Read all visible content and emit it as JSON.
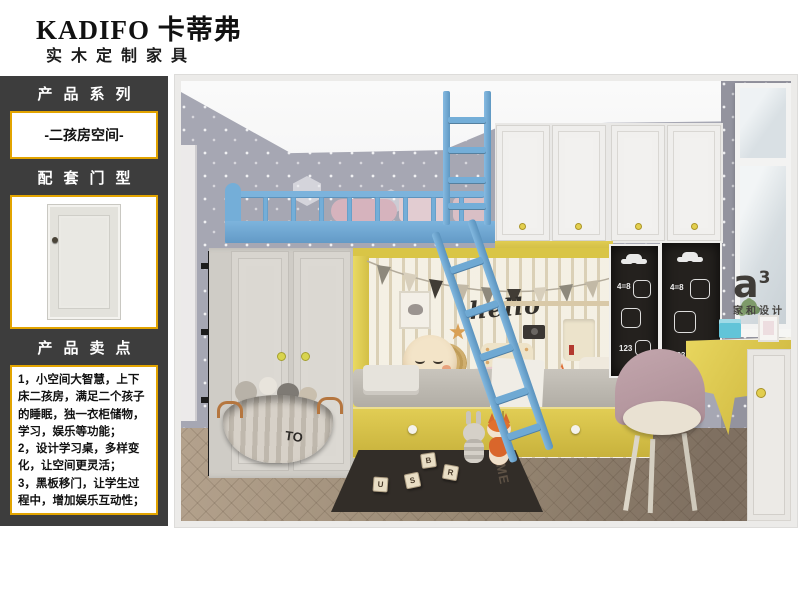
{
  "header": {
    "brand": "KADIFO 卡蒂弗",
    "tagline": "实木定制家具"
  },
  "sidebar": {
    "series_title": "产品系列",
    "series_value": "-二孩房空间-",
    "door_title": "配套门型",
    "points_title": "产品卖点",
    "points": [
      "1，小空间大智慧，上下床二孩房，满足二个孩子的睡眠，独一衣柜储物，学习，娱乐等功能；",
      "2，设计学习桌，多样变化，让空间更灵活；",
      "3，黑板移门，让学生过程中，增加娱乐互动性；"
    ],
    "accent_border": "#e2a400"
  },
  "scene": {
    "hello_text": "hello",
    "basket_label": "TO",
    "rug_text": "HOME",
    "chalk_left": {
      "t1": "4=8",
      "t2": "123"
    },
    "chalk_right": {
      "t1": "4=8",
      "t2": "123"
    },
    "blocks": [
      "B",
      "R",
      "U",
      "S"
    ],
    "watermark": {
      "logo": "a",
      "sup": "3",
      "name": "家和设计"
    },
    "colors": {
      "ladder_blue": "#74aed8",
      "cabinet_yellow": "#ddc94f",
      "wallpaper": "#a6a7b3",
      "chalkboard": "#24211e"
    }
  }
}
